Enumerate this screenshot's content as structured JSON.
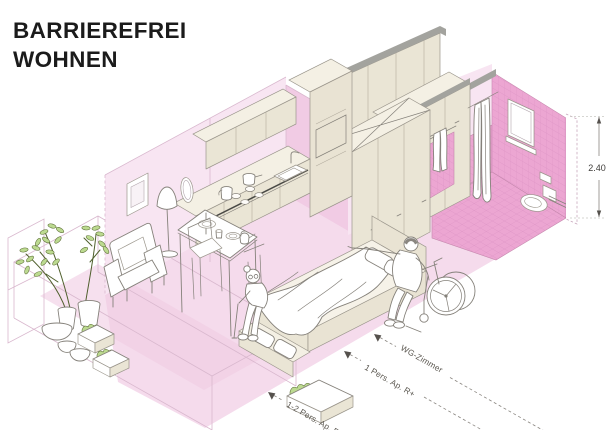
{
  "title": {
    "line1": "BARRIEREFREI",
    "line2": "WOHNEN"
  },
  "dimensions": {
    "height_label": "2.40",
    "modules": [
      {
        "label": "WG-Zimmer"
      },
      {
        "label": "1 Pers. Ap. R+"
      },
      {
        "label": "1-2 Pers. Ap. R+"
      }
    ]
  },
  "scene": {
    "type": "isometric-cutaway-apartment",
    "areas": [
      {
        "name": "balcony-planters"
      },
      {
        "name": "living-dining"
      },
      {
        "name": "kitchen"
      },
      {
        "name": "sleeping-area"
      },
      {
        "name": "wardrobe-corridor"
      },
      {
        "name": "accessible-bathroom"
      }
    ],
    "figures": [
      {
        "name": "elderly-woman-sitting-on-bed"
      },
      {
        "name": "man-transferring-from-wheelchair"
      }
    ]
  },
  "colors": {
    "background": "#FFFFFF",
    "floor_pink": "#F5DBEC",
    "wall_pink": "#F8E5F2",
    "wall_pink_shade": "#F1CBE4",
    "tile_pink": "#ECA6D2",
    "tile_grid": "#DD93C5",
    "cabinet_cream": "#EAE5D5",
    "cabinet_top": "#F4F0E4",
    "gray_band": "#A3A39E",
    "leaf_green": "#BCDA90",
    "outline": "#85817A",
    "title_text": "#1B1B1B",
    "dim_text": "#55514D"
  }
}
